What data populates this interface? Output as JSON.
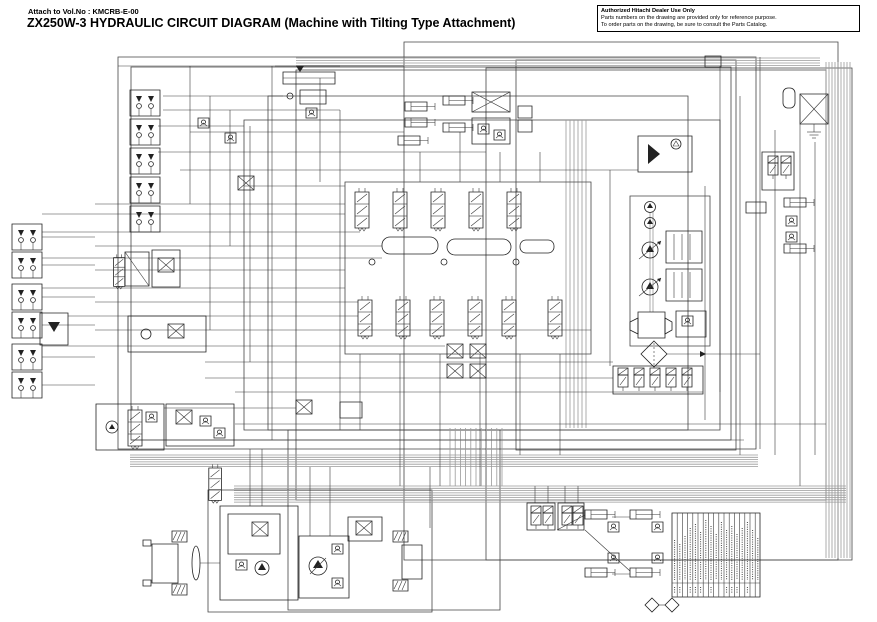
{
  "header": {
    "attach_no": "Attach to Vol.No : KMCRB-E-00",
    "title": "ZX250W-3 HYDRAULIC CIRCUIT DIAGRAM (Machine with Tilting Type Attachment)"
  },
  "notice": {
    "line1": "Authorized Hitachi Dealer Use Only",
    "line2": "Parts numbers on the drawing are provided only for reference purpose.",
    "line3": "To order parts on the drawing, be sure to consult the Parts Catalog."
  },
  "colors": {
    "line": "#3a3a3a",
    "bus": "#9a9a9a",
    "ink": "#000000",
    "paper": "#ffffff"
  },
  "legend_table": {
    "column_count": 17,
    "has_bottom_code_row": true
  },
  "diagram": {
    "component_icons": [
      "pilot-valve-stack-icon",
      "remote-pilot-units-icon",
      "main-control-valve-icon",
      "spool-valve-icon",
      "boom-cylinder-icon",
      "pilot-shuttle-block-icon",
      "hydraulic-oil-tank-icon",
      "gear-pump-icon",
      "variable-pump-icon",
      "engine-icon",
      "oil-filter-icon",
      "pump-regulator-icon",
      "solenoid-manifold-icon",
      "oil-cooler-icon",
      "accumulator-icon",
      "front-axle-icon",
      "rear-axle-icon",
      "transmission-icon",
      "travel-motor-icon",
      "steering-valve-icon",
      "stabilizer-cylinder-icon",
      "pilot-check-valve-icon",
      "tilting-attachment-solenoid-icon",
      "hose-legend-table"
    ]
  }
}
